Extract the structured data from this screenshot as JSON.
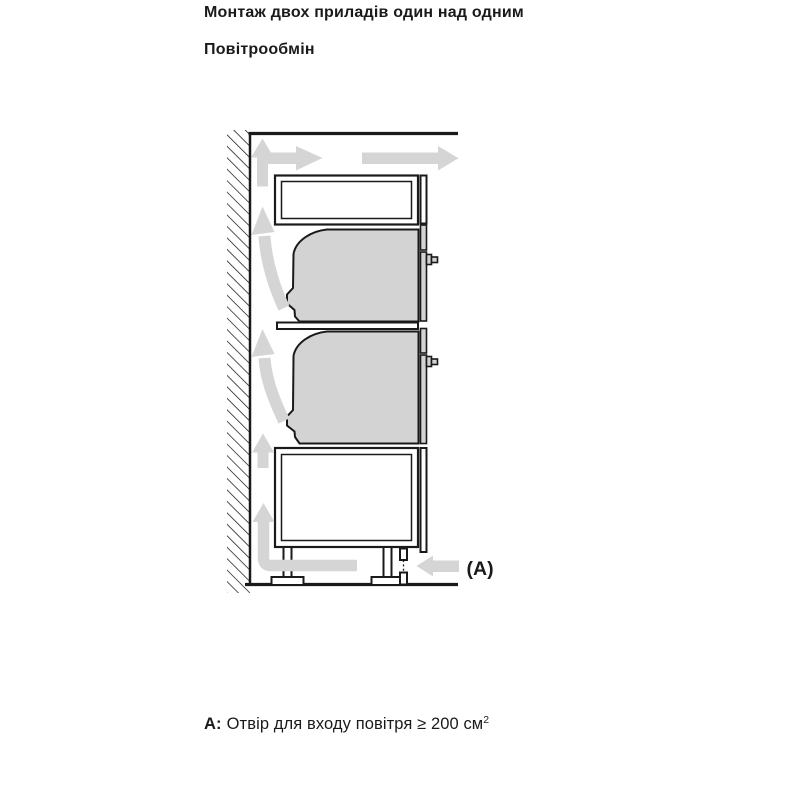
{
  "heading": {
    "title": "Монтаж двох приладів один над одним",
    "subtitle": "Повітрообмін"
  },
  "diagram": {
    "label_a": "(A)",
    "colors": {
      "line": "#1a1a1a",
      "appliance_fill": "#d3d3d3",
      "arrow_fill": "#d5d5d5",
      "background": "#ffffff"
    }
  },
  "caption": {
    "prefix": "A:",
    "text": "Отвір для входу повітря ≥ 200 см",
    "superscript": "2"
  }
}
